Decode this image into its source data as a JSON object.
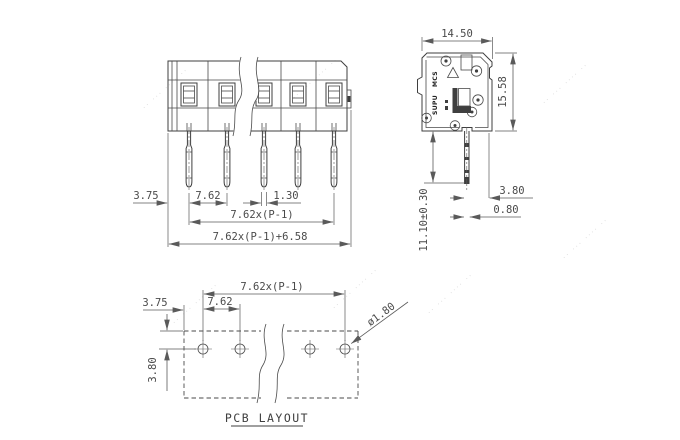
{
  "front_view": {
    "dim_body_edge_to_pin": "3.75",
    "dim_pitch": "7.62",
    "dim_pin_width": "1.30",
    "dim_pin_span": "7.62x(P-1)",
    "dim_overall_length": "7.62x(P-1)+6.58"
  },
  "side_view": {
    "dim_width": "14.50",
    "dim_height": "15.58",
    "dim_pin_to_face": "3.80",
    "dim_pin_thickness": "0.80",
    "dim_pin_length": "11.10±0.30",
    "brand_line1": "SUPU",
    "brand_line2": "MCS"
  },
  "pcb_layout": {
    "dim_hole_span": "7.62x(P-1)",
    "dim_edge_to_hole": "3.75",
    "dim_hole_pitch": "7.62",
    "dim_row_offset": "3.80",
    "dim_hole_diameter": "ø1.80",
    "caption": "PCB LAYOUT"
  },
  "watermark": {
    "glyphs": "·· ··· ···· ··"
  },
  "colors": {
    "object_line": "#3f3f3f",
    "dimension_line": "#5a5a5a",
    "text": "#4a4a4a",
    "watermark": "#d6d6d6",
    "background": "#ffffff"
  }
}
